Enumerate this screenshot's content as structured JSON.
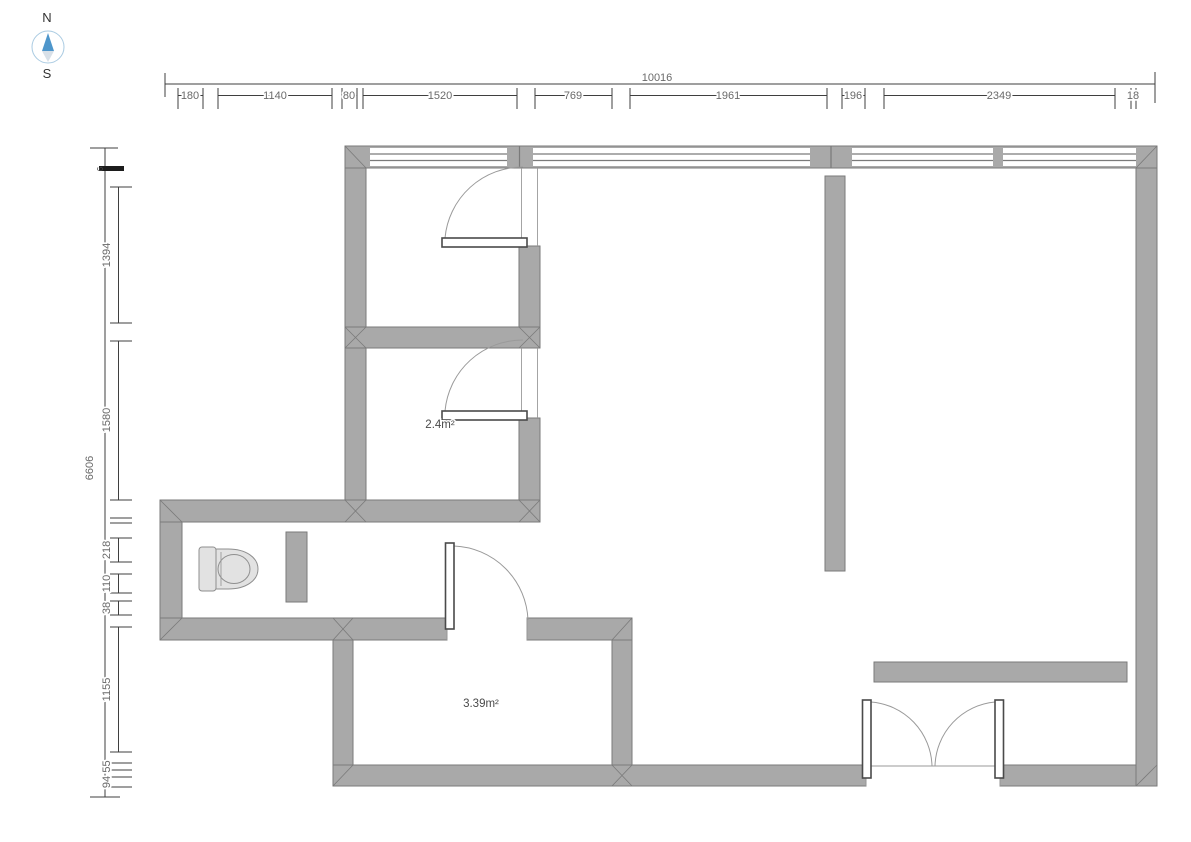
{
  "compass": {
    "north": "N",
    "south": "S"
  },
  "dimensions": {
    "top": {
      "total": "10016",
      "segments": [
        {
          "label": "180"
        },
        {
          "label": "1140"
        },
        {
          "label": "80"
        },
        {
          "label": "1520"
        },
        {
          "label": "769"
        },
        {
          "label": "1961"
        },
        {
          "label": "196"
        },
        {
          "label": "2349"
        },
        {
          "label": "18"
        }
      ]
    },
    "left": {
      "total": "6606",
      "segments": [
        {
          "label": "6"
        },
        {
          "label": "1394"
        },
        {
          "label": "1580"
        },
        {
          "label": ""
        },
        {
          "label": "218"
        },
        {
          "label": "110"
        },
        {
          "label": "38"
        },
        {
          "label": "1155"
        },
        {
          "label": "55"
        },
        {
          "label": "94"
        }
      ]
    }
  },
  "room_labels": [
    {
      "area": "2.4m²"
    },
    {
      "area": "3.39m²"
    }
  ],
  "colors": {
    "wall_fill": "#a9a9a9",
    "wall_stroke": "#7a7a7a",
    "dim_line": "#3f3f3f",
    "dim_text": "#6a6a6a",
    "door_arc": "#9a9a9a",
    "fixture_fill": "#e2e2e2",
    "compass_needle_north": "#4e96cb",
    "compass_needle_south": "#d8e0e8"
  }
}
